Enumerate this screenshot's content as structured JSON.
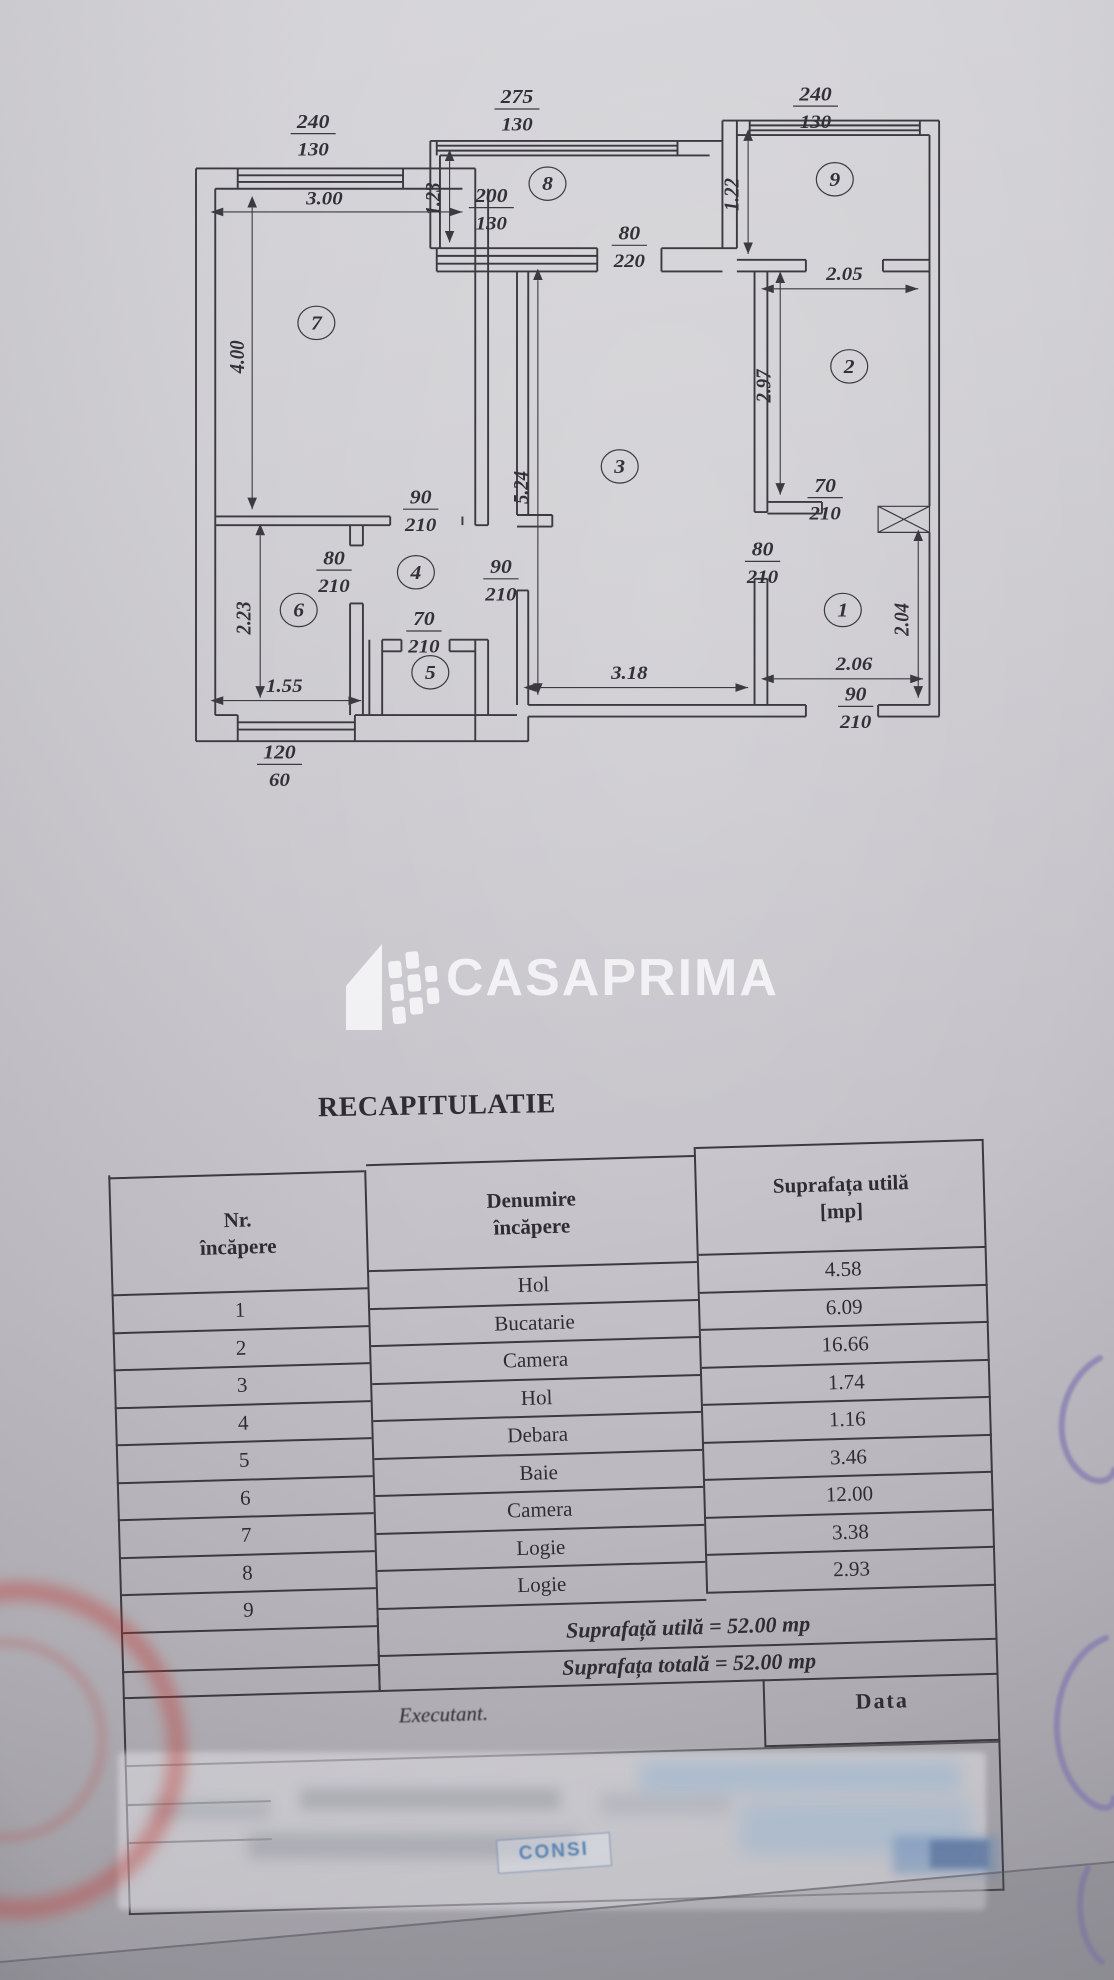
{
  "document": {
    "logo": {
      "text": "CASAPRIMA"
    },
    "title": "RECAPITULATIE",
    "table": {
      "header": {
        "col1": [
          "Nr.",
          "încăpere"
        ],
        "col2": [
          "Denumire",
          "încăpere"
        ],
        "col3": [
          "Suprafața utilă",
          "[mp]"
        ]
      },
      "rows": [
        {
          "nr": "1",
          "name": "Hol",
          "area": "4.58"
        },
        {
          "nr": "2",
          "name": "Bucatarie",
          "area": "6.09"
        },
        {
          "nr": "3",
          "name": "Camera",
          "area": "16.66"
        },
        {
          "nr": "4",
          "name": "Hol",
          "area": "1.74"
        },
        {
          "nr": "5",
          "name": "Debara",
          "area": "1.16"
        },
        {
          "nr": "6",
          "name": "Baie",
          "area": "3.46"
        },
        {
          "nr": "7",
          "name": "Camera",
          "area": "12.00"
        },
        {
          "nr": "8",
          "name": "Logie",
          "area": "3.38"
        },
        {
          "nr": "9",
          "name": "Logie",
          "area": "2.93"
        }
      ],
      "totals": [
        "Suprafață utilă = 52.00 mp",
        "Suprafața totală = 52.00 mp"
      ],
      "executant_label": "Executant.",
      "data_label": "Data",
      "stamp_text": "CONSI"
    },
    "plan": {
      "door_window_labels": [
        {
          "num": "240",
          "den": "130",
          "x": 113,
          "y": 57
        },
        {
          "num": "275",
          "den": "130",
          "x": 240,
          "y": 40
        },
        {
          "num": "240",
          "den": "130",
          "x": 426,
          "y": 38
        },
        {
          "num": "200",
          "den": "130",
          "x": 224,
          "y": 108
        },
        {
          "num": "80",
          "den": "220",
          "x": 310,
          "y": 134
        },
        {
          "num": "90",
          "den": "210",
          "x": 180,
          "y": 316
        },
        {
          "num": "80",
          "den": "210",
          "x": 126,
          "y": 358
        },
        {
          "num": "90",
          "den": "210",
          "x": 230,
          "y": 364
        },
        {
          "num": "70",
          "den": "210",
          "x": 182,
          "y": 400
        },
        {
          "num": "80",
          "den": "210",
          "x": 393,
          "y": 352
        },
        {
          "num": "70",
          "den": "210",
          "x": 432,
          "y": 308
        },
        {
          "num": "90",
          "den": "210",
          "x": 451,
          "y": 452
        },
        {
          "num": "120",
          "den": "60",
          "x": 92,
          "y": 492
        }
      ],
      "dimensions": [
        {
          "text": "3.00",
          "x": 120,
          "y": 110,
          "rot": 0
        },
        {
          "text": "4.00",
          "x": 70,
          "y": 215,
          "rot": -90
        },
        {
          "text": "2.23",
          "x": 74,
          "y": 395,
          "rot": -90
        },
        {
          "text": "1.55",
          "x": 95,
          "y": 446,
          "rot": 0
        },
        {
          "text": "5.24",
          "x": 247,
          "y": 305,
          "rot": -90
        },
        {
          "text": "3.18",
          "x": 310,
          "y": 437,
          "rot": 0
        },
        {
          "text": "1.23",
          "x": 192,
          "y": 106,
          "rot": -90
        },
        {
          "text": "1.22",
          "x": 378,
          "y": 103,
          "rot": -90
        },
        {
          "text": "2.05",
          "x": 444,
          "y": 162,
          "rot": 0
        },
        {
          "text": "2.97",
          "x": 398,
          "y": 235,
          "rot": -90
        },
        {
          "text": "2.04",
          "x": 484,
          "y": 396,
          "rot": -90
        },
        {
          "text": "2.06",
          "x": 450,
          "y": 431,
          "rot": 0
        }
      ],
      "rooms": [
        {
          "number": "7",
          "x": 115,
          "y": 196
        },
        {
          "number": "8",
          "x": 259,
          "y": 100
        },
        {
          "number": "9",
          "x": 438,
          "y": 97
        },
        {
          "number": "2",
          "x": 447,
          "y": 226
        },
        {
          "number": "3",
          "x": 304,
          "y": 295
        },
        {
          "number": "4",
          "x": 177,
          "y": 368
        },
        {
          "number": "6",
          "x": 104,
          "y": 394
        },
        {
          "number": "5",
          "x": 186,
          "y": 437
        },
        {
          "number": "1",
          "x": 443,
          "y": 394
        }
      ]
    },
    "colors": {
      "ink": "#3a3a40",
      "paper": "#cac8ce",
      "logo_white": "#fafafc",
      "stamp_red": "#c1342f",
      "pen_purple": "#8178b0",
      "signature_blue": "#6f94c2"
    }
  }
}
